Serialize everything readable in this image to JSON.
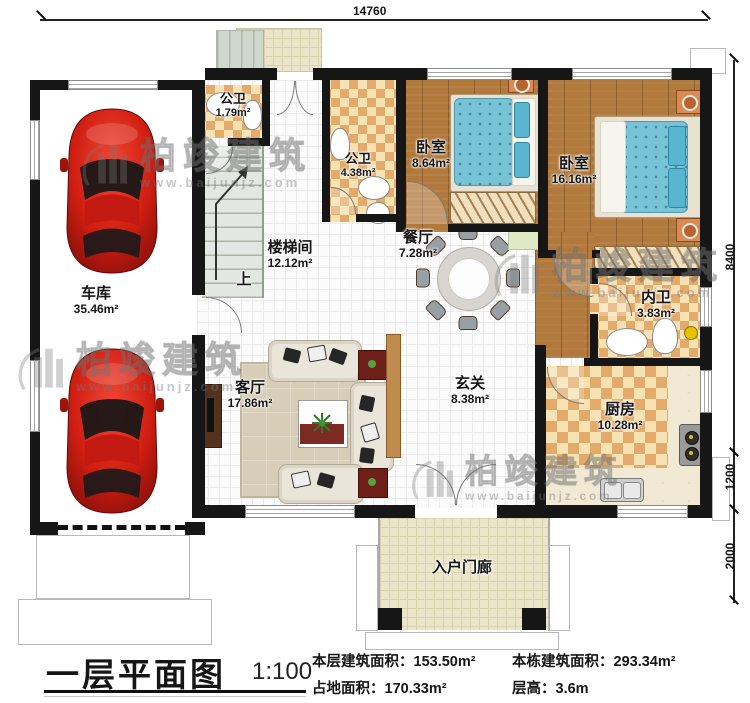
{
  "plan": {
    "dimensions": {
      "width_total": "14760",
      "height_main": "8400",
      "height_step1": "1200",
      "height_step2": "2000"
    },
    "rooms": {
      "garage": {
        "name": "车库",
        "area": "35.46m²"
      },
      "bath_small": {
        "name": "公卫",
        "area": "1.79m²"
      },
      "bath_hall": {
        "name": "公卫",
        "area": "4.38m²"
      },
      "bedroom1": {
        "name": "卧室",
        "area": "8.64m²"
      },
      "bedroom2": {
        "name": "卧室",
        "area": "16.16m²"
      },
      "stairwell": {
        "name": "楼梯间",
        "area": "12.12m²"
      },
      "dining": {
        "name": "餐厅",
        "area": "7.28m²"
      },
      "ensuite": {
        "name": "内卫",
        "area": "3.83m²"
      },
      "living": {
        "name": "客厅",
        "area": "17.86m²"
      },
      "foyer": {
        "name": "玄关",
        "area": "8.38m²"
      },
      "kitchen": {
        "name": "厨房",
        "area": "10.28m²"
      },
      "porch": {
        "name": "入户门廊"
      }
    },
    "stairs_up_label": "上"
  },
  "watermark": {
    "brand": "柏竣建筑",
    "url": "www.baijunjz.com"
  },
  "title_block": {
    "title": "一层平面图",
    "scale": "1:100",
    "stats": [
      {
        "label": "本层建筑面积：",
        "value": "153.50m²"
      },
      {
        "label": "占地面积：",
        "value": "170.33m²"
      },
      {
        "label": "本栋建筑面积：",
        "value": "293.34m²"
      },
      {
        "label": "层高：",
        "value": "3.6m"
      }
    ]
  },
  "colors": {
    "wall": "#161616",
    "car": "#d01f12",
    "bed": "#79c3d7",
    "tile_accent": "#e3aa6c"
  }
}
